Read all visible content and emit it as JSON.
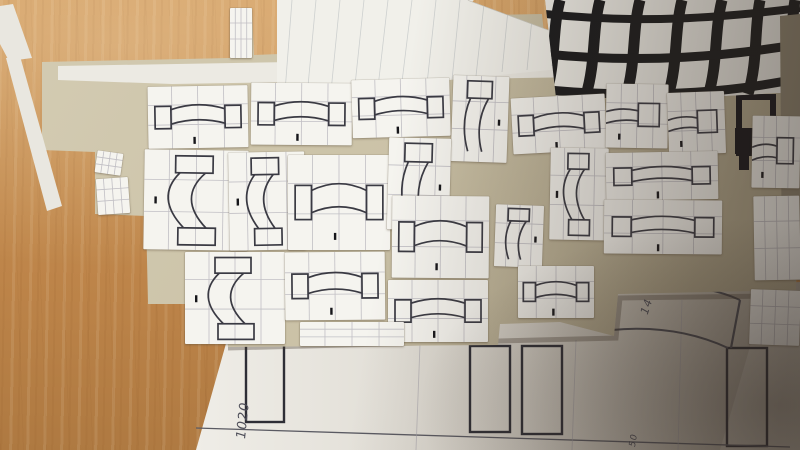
{
  "scene": {
    "setting": "Top-down photograph of a light oak desk covered with paper cutouts used for a technical drawing layout",
    "objects": [
      "wooden desk surface",
      "large white technical drawing sheet at bottom with dark ink column rectangles, baseline and concentric arcs",
      "kraft/tan backing board in the centre",
      "about two dozen small white sketch cards, each with a pencil grid and an arch segment drawing (two abutment rectangles joined by a curved band)",
      "papers with bold hand-drawn black grids at the top edge",
      "white sheet with faint ruled pencil lines laid diagonally over the grid papers",
      "small black window-like ink shape on the right of the board",
      "strong shadow falling across the right third of the scene"
    ],
    "colors": {
      "desk_wood": "#c68f52",
      "kraft_board": "#cbc2a7",
      "sketch_card": "#f5f4ef",
      "sketch_ink": "#3a3a43",
      "pencil_grid": "#b4b2ba",
      "bold_grid_black": "#191a1c",
      "drawing_sheet": "#e9e6df",
      "shadow": "#46382c"
    }
  },
  "annotations": [
    {
      "text": "1020"
    },
    {
      "text": "14"
    },
    {
      "text": "50"
    }
  ],
  "cards": [
    {
      "x": 148,
      "y": 86,
      "w": 100,
      "h": 62,
      "r": -1,
      "v": "arch-h"
    },
    {
      "x": 251,
      "y": 83,
      "w": 101,
      "h": 62,
      "r": 0.5,
      "v": "arch-h"
    },
    {
      "x": 352,
      "y": 79,
      "w": 98,
      "h": 58,
      "r": -1.5,
      "v": "arch-h"
    },
    {
      "x": 452,
      "y": 76,
      "w": 56,
      "h": 86,
      "r": 2,
      "v": "stub-v"
    },
    {
      "x": 512,
      "y": 96,
      "w": 94,
      "h": 56,
      "r": -3,
      "v": "arch-h"
    },
    {
      "x": 606,
      "y": 84,
      "w": 62,
      "h": 64,
      "r": 1,
      "v": "stub-h"
    },
    {
      "x": 668,
      "y": 92,
      "w": 57,
      "h": 62,
      "r": -2,
      "v": "stub-h"
    },
    {
      "x": 144,
      "y": 150,
      "w": 104,
      "h": 100,
      "r": 0.8,
      "v": "arch-v"
    },
    {
      "x": 229,
      "y": 152,
      "w": 76,
      "h": 98,
      "r": -1,
      "v": "arch-v"
    },
    {
      "x": 288,
      "y": 155,
      "w": 102,
      "h": 95,
      "r": 0,
      "v": "arch-h"
    },
    {
      "x": 388,
      "y": 138,
      "w": 62,
      "h": 92,
      "r": 1.5,
      "v": "stub-v"
    },
    {
      "x": 550,
      "y": 148,
      "w": 58,
      "h": 92,
      "r": 1,
      "v": "arch-v"
    },
    {
      "x": 606,
      "y": 152,
      "w": 112,
      "h": 48,
      "r": -1,
      "v": "arch-h"
    },
    {
      "x": 604,
      "y": 200,
      "w": 118,
      "h": 54,
      "r": 0.5,
      "v": "arch-h"
    },
    {
      "x": 185,
      "y": 252,
      "w": 100,
      "h": 92,
      "r": 0,
      "v": "arch-v"
    },
    {
      "x": 285,
      "y": 252,
      "w": 100,
      "h": 68,
      "r": -0.5,
      "v": "arch-h"
    },
    {
      "x": 392,
      "y": 196,
      "w": 97,
      "h": 82,
      "r": 0.5,
      "v": "arch-h"
    },
    {
      "x": 388,
      "y": 280,
      "w": 100,
      "h": 62,
      "r": 0,
      "v": "arch-h"
    },
    {
      "x": 495,
      "y": 205,
      "w": 48,
      "h": 62,
      "r": 2,
      "v": "stub-v"
    },
    {
      "x": 518,
      "y": 266,
      "w": 76,
      "h": 52,
      "r": 0,
      "v": "arch-h"
    },
    {
      "x": 300,
      "y": 322,
      "w": 104,
      "h": 24,
      "r": 0,
      "v": "blank"
    },
    {
      "x": 752,
      "y": 116,
      "w": 48,
      "h": 72,
      "r": 1,
      "v": "stub-h"
    },
    {
      "x": 754,
      "y": 196,
      "w": 46,
      "h": 84,
      "r": -1,
      "v": "blank"
    },
    {
      "x": 750,
      "y": 290,
      "w": 50,
      "h": 55,
      "r": 2,
      "v": "blank"
    },
    {
      "x": 96,
      "y": 152,
      "w": 26,
      "h": 22,
      "r": 8,
      "v": "blank"
    },
    {
      "x": 97,
      "y": 178,
      "w": 32,
      "h": 36,
      "r": -4,
      "v": "blank"
    },
    {
      "x": 230,
      "y": 8,
      "w": 22,
      "h": 50,
      "r": 0,
      "v": "blank"
    }
  ]
}
